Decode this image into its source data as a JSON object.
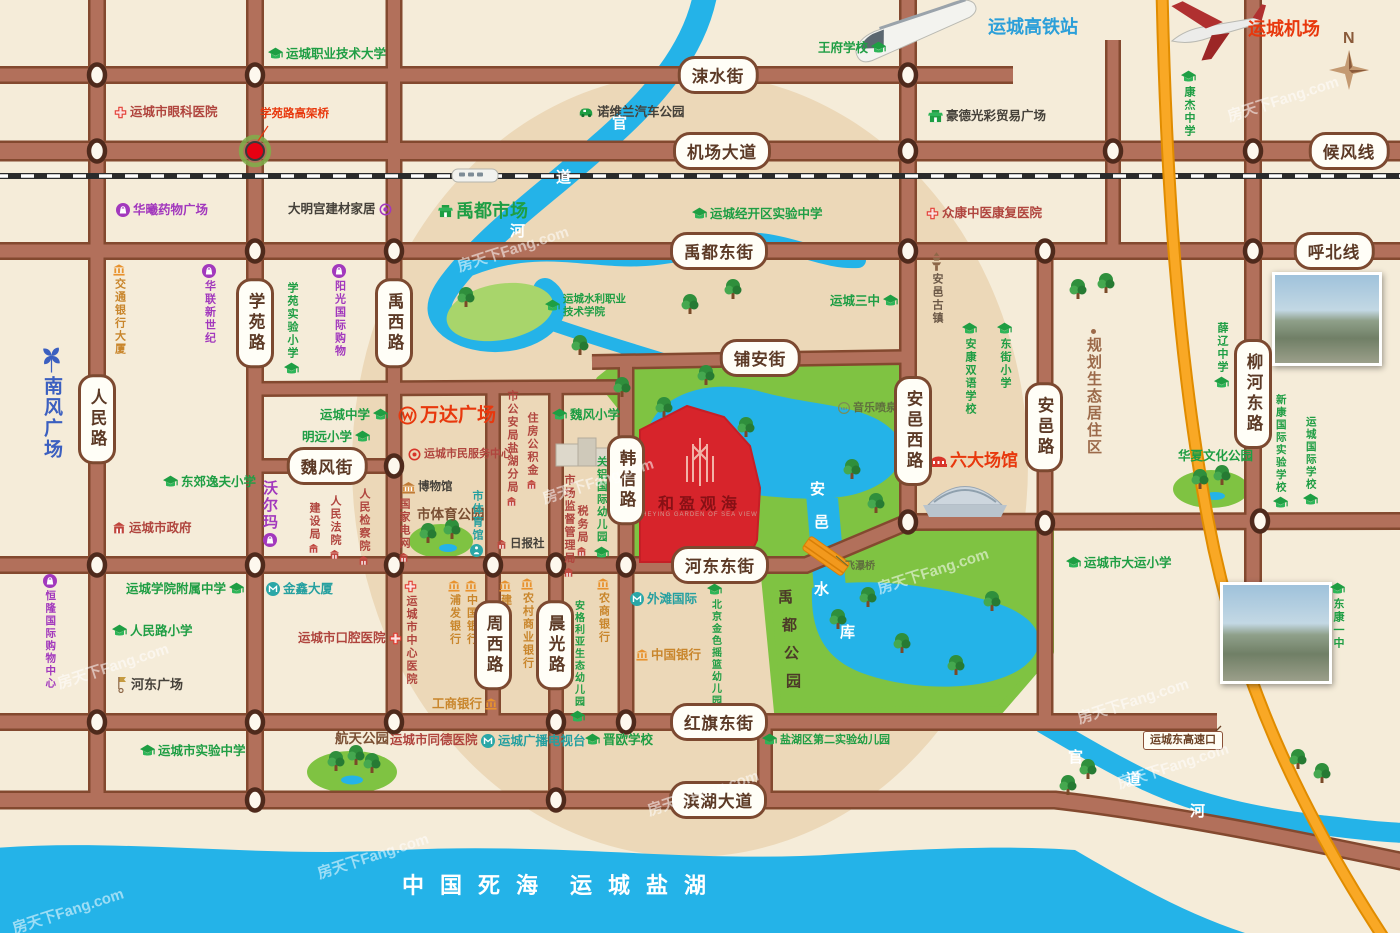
{
  "watermark": "房天下Fang.com",
  "compass_label": "N",
  "project": {
    "name": "和盈观海",
    "subtitle": "HEYING GARDEN OF SEA VIEW"
  },
  "sea": {
    "labels": [
      "中国死海",
      "运城盐湖"
    ]
  },
  "river_name": "官道河",
  "reservoir_name": "安邑水库",
  "park_name": "禹都公园",
  "road_labels": [
    {
      "text": "涑水街",
      "x": 718,
      "y": 75
    },
    {
      "text": "机场大道",
      "x": 722,
      "y": 151
    },
    {
      "text": "候风线",
      "x": 1349,
      "y": 151
    },
    {
      "text": "禹都东街",
      "x": 719,
      "y": 251
    },
    {
      "text": "呼北线",
      "x": 1334,
      "y": 251
    },
    {
      "text": "铺安街",
      "x": 760,
      "y": 358
    },
    {
      "text": "魏风街",
      "x": 327,
      "y": 466
    },
    {
      "text": "河东东街",
      "x": 720,
      "y": 565
    },
    {
      "text": "红旗东街",
      "x": 719,
      "y": 722
    },
    {
      "text": "滨湖大道",
      "x": 718,
      "y": 800
    },
    {
      "text": "人民路",
      "x": 97,
      "y": 419,
      "vertical": true
    },
    {
      "text": "学苑路",
      "x": 255,
      "y": 323,
      "vertical": true
    },
    {
      "text": "禹西路",
      "x": 394,
      "y": 323,
      "vertical": true
    },
    {
      "text": "周西路",
      "x": 493,
      "y": 645,
      "vertical": true
    },
    {
      "text": "晨光路",
      "x": 555,
      "y": 645,
      "vertical": true
    },
    {
      "text": "韩信路",
      "x": 626,
      "y": 480,
      "vertical": true
    },
    {
      "text": "安邑西路",
      "x": 913,
      "y": 431,
      "vertical": true
    },
    {
      "text": "安邑路",
      "x": 1044,
      "y": 427,
      "vertical": true
    },
    {
      "text": "柳河东路",
      "x": 1253,
      "y": 394,
      "vertical": true
    }
  ],
  "places": [
    {
      "l": "运城高铁站",
      "t": "blue",
      "x": 988,
      "y": 18,
      "fs": 18
    },
    {
      "l": "王府学校",
      "t": "school",
      "x": 818,
      "y": 41,
      "ip": "r"
    },
    {
      "l": "运城机场",
      "t": "redbig",
      "x": 1248,
      "y": 20,
      "fs": 18
    },
    {
      "l": "康杰中学",
      "t": "school",
      "x": 1181,
      "y": 70,
      "v": 1,
      "ip": "t"
    },
    {
      "l": "运城职业技术大学",
      "t": "school",
      "x": 268,
      "y": 47,
      "ip": "l"
    },
    {
      "l": "运城市眼科医院",
      "t": "hospital",
      "x": 114,
      "y": 106,
      "ip": "l"
    },
    {
      "l": "学苑路高架桥",
      "t": "redsmall",
      "x": 260,
      "y": 109,
      "fs": 11.5
    },
    {
      "l": "诺维兰汽车公园",
      "t": "dark",
      "x": 578,
      "y": 106,
      "ip": "l",
      "icon": "car"
    },
    {
      "l": "豪德光彩贸易广场",
      "t": "dark",
      "x": 928,
      "y": 110,
      "ip": "l",
      "icon": "market"
    },
    {
      "l": "华曦药物广场",
      "t": "shop",
      "x": 116,
      "y": 203,
      "ip": "l"
    },
    {
      "l": "大明宫建材家居",
      "t": "dark",
      "x": 288,
      "y": 203,
      "ip": "r",
      "icon": "pcircle"
    },
    {
      "l": "禹都市场",
      "t": "market",
      "x": 438,
      "y": 202,
      "ip": "l",
      "fs": 18
    },
    {
      "l": "运城经开区实验中学",
      "t": "school",
      "x": 692,
      "y": 207,
      "ip": "l"
    },
    {
      "l": "众康中医康复医院",
      "t": "hospital",
      "x": 926,
      "y": 207,
      "ip": "l"
    },
    {
      "l": "运城三中",
      "t": "school",
      "x": 830,
      "y": 294,
      "ip": "r"
    },
    {
      "l": "安邑古镇",
      "t": "pagoda",
      "x": 930,
      "y": 252,
      "v": 1,
      "ip": "t"
    },
    {
      "l": "安康双语学校",
      "t": "school",
      "x": 962,
      "y": 322,
      "v": 1,
      "ip": "t"
    },
    {
      "l": "东街小学",
      "t": "school",
      "x": 997,
      "y": 322,
      "v": 1,
      "ip": "t"
    },
    {
      "l": "运城水利职业技术学院",
      "t": "school2",
      "x": 545,
      "y": 293,
      "ip": "l"
    },
    {
      "l": "薛辽中学",
      "t": "school",
      "x": 1214,
      "y": 322,
      "v": 1,
      "ip": "b"
    },
    {
      "l": "规划生态居住区",
      "t": "brown",
      "x": 1086,
      "y": 328,
      "v": 1,
      "ip": "t",
      "icon": "dot",
      "fs": 15
    },
    {
      "l": "新康国际实验学校",
      "t": "school",
      "x": 1273,
      "y": 394,
      "v": 1,
      "ip": "b",
      "fs": 10.5
    },
    {
      "l": "运城国际学校",
      "t": "school",
      "x": 1303,
      "y": 416,
      "v": 1,
      "ip": "b",
      "fs": 10.5
    },
    {
      "l": "交通银行大厦",
      "t": "bank",
      "x": 113,
      "y": 264,
      "v": 1,
      "ip": "t"
    },
    {
      "l": "华联新世纪",
      "t": "shop",
      "x": 202,
      "y": 264,
      "v": 1,
      "ip": "t"
    },
    {
      "l": "学苑实验小学",
      "t": "school",
      "x": 284,
      "y": 282,
      "v": 1,
      "ip": "b"
    },
    {
      "l": "阳光国际购物",
      "t": "shop",
      "x": 332,
      "y": 264,
      "v": 1,
      "ip": "t"
    },
    {
      "l": "南风广场",
      "t": "bluev",
      "x": 38,
      "y": 342,
      "v": 1,
      "ip": "t",
      "icon": "pinwheel",
      "fs": 19
    },
    {
      "l": "东郊逸夫小学",
      "t": "school",
      "x": 163,
      "y": 475,
      "ip": "l"
    },
    {
      "l": "运城中学",
      "t": "school",
      "x": 320,
      "y": 408,
      "ip": "r"
    },
    {
      "l": "明远小学",
      "t": "school",
      "x": 302,
      "y": 430,
      "ip": "r"
    },
    {
      "l": "沃尔玛",
      "t": "shop",
      "x": 262,
      "y": 480,
      "v": 1,
      "ip": "b",
      "fs": 15
    },
    {
      "l": "运城市政府",
      "t": "gov",
      "x": 112,
      "y": 521,
      "ip": "l"
    },
    {
      "l": "建设局",
      "t": "govs",
      "x": 308,
      "y": 502,
      "v": 1,
      "ip": "b"
    },
    {
      "l": "人民法院",
      "t": "govs",
      "x": 329,
      "y": 495,
      "v": 1,
      "ip": "b"
    },
    {
      "l": "人民检察院",
      "t": "govs",
      "x": 358,
      "y": 488,
      "v": 1,
      "ip": "b"
    },
    {
      "l": "万达广场",
      "t": "redbig",
      "x": 398,
      "y": 406,
      "ip": "l",
      "icon": "wanda",
      "fs": 19
    },
    {
      "l": "运城市民服务中心",
      "t": "redsm",
      "x": 408,
      "y": 448,
      "ip": "l",
      "icon": "target",
      "fs": 11
    },
    {
      "l": "博物馆",
      "t": "dark",
      "x": 402,
      "y": 482,
      "ip": "l",
      "icon": "museum",
      "fs": 11.5
    },
    {
      "l": "国家电网",
      "t": "govs",
      "x": 398,
      "y": 498,
      "v": 1,
      "ip": "b"
    },
    {
      "l": "市体育公园",
      "t": "brownbold",
      "x": 417,
      "y": 508,
      "fs": 13.5
    },
    {
      "l": "市体育馆",
      "t": "stadium",
      "x": 470,
      "y": 490,
      "v": 1,
      "ip": "b"
    },
    {
      "l": "日报社",
      "t": "dark",
      "x": 496,
      "y": 539,
      "ip": "l",
      "icon": "govsm",
      "fs": 11.5
    },
    {
      "l": "市公安局盐湖分局",
      "t": "govs",
      "x": 506,
      "y": 390,
      "v": 1,
      "ip": "b"
    },
    {
      "l": "住房公积金",
      "t": "govs",
      "x": 526,
      "y": 412,
      "v": 1,
      "ip": "b"
    },
    {
      "l": "魏风小学",
      "t": "school",
      "x": 552,
      "y": 408,
      "ip": "l"
    },
    {
      "l": "关铝国际幼儿园",
      "t": "school",
      "x": 594,
      "y": 456,
      "v": 1,
      "ip": "b",
      "fs": 10.5
    },
    {
      "l": "市场监督管理局",
      "t": "govs",
      "x": 563,
      "y": 474,
      "v": 1,
      "ip": "b"
    },
    {
      "l": "税务局",
      "t": "govs",
      "x": 576,
      "y": 505,
      "v": 1,
      "ip": "b"
    },
    {
      "l": "音乐喷泉",
      "t": "fountain",
      "x": 838,
      "y": 402,
      "ip": "l",
      "fs": 11
    },
    {
      "l": "六大场馆",
      "t": "redbig",
      "x": 930,
      "y": 452,
      "ip": "l",
      "icon": "venues",
      "fs": 17
    },
    {
      "l": "恒隆国际购物中心",
      "t": "shop",
      "x": 43,
      "y": 574,
      "v": 1,
      "ip": "t",
      "fs": 10.5
    },
    {
      "l": "运城学院附属中学",
      "t": "school",
      "x": 126,
      "y": 582,
      "ip": "r"
    },
    {
      "l": "金鑫大厦",
      "t": "office",
      "x": 266,
      "y": 582,
      "ip": "l"
    },
    {
      "l": "人民路小学",
      "t": "school",
      "x": 112,
      "y": 624,
      "ip": "l"
    },
    {
      "l": "运城市口腔医院",
      "t": "hospital",
      "x": 298,
      "y": 632,
      "ip": "r"
    },
    {
      "l": "河东广场",
      "t": "dark",
      "x": 116,
      "y": 676,
      "ip": "l",
      "icon": "flag",
      "fs": 13
    },
    {
      "l": "运城市中心医院",
      "t": "hospital",
      "x": 404,
      "y": 580,
      "v": 1,
      "ip": "t"
    },
    {
      "l": "浦发银行",
      "t": "bank",
      "x": 448,
      "y": 580,
      "v": 1,
      "ip": "t"
    },
    {
      "l": "中国银行",
      "t": "bank",
      "x": 465,
      "y": 580,
      "v": 1,
      "ip": "t"
    },
    {
      "l": "建设银行",
      "t": "bank",
      "x": 499,
      "y": 580,
      "v": 1,
      "ip": "t"
    },
    {
      "l": "农村商业银行",
      "t": "bank",
      "x": 521,
      "y": 578,
      "v": 1,
      "ip": "t"
    },
    {
      "l": "农商银行",
      "t": "bank",
      "x": 597,
      "y": 578,
      "v": 1,
      "ip": "t"
    },
    {
      "l": "安格利亚生态幼儿园",
      "t": "school",
      "x": 570,
      "y": 600,
      "v": 1,
      "ip": "b",
      "fs": 10
    },
    {
      "l": "外滩国际",
      "t": "office",
      "x": 630,
      "y": 592,
      "ip": "l"
    },
    {
      "l": "北京金色摇篮幼儿园",
      "t": "school",
      "x": 707,
      "y": 583,
      "v": 1,
      "ip": "t",
      "fs": 10
    },
    {
      "l": "中国银行",
      "t": "bank",
      "x": 636,
      "y": 649,
      "ip": "l",
      "fs": 12.5
    },
    {
      "l": "工商银行",
      "t": "bank",
      "x": 432,
      "y": 698,
      "ip": "r",
      "fs": 12.5
    },
    {
      "l": "运城市同德医院",
      "t": "hospital",
      "x": 390,
      "y": 734,
      "ip": "r"
    },
    {
      "l": "运城广播电视台",
      "t": "office",
      "x": 481,
      "y": 734,
      "ip": "l"
    },
    {
      "l": "晋欧学校",
      "t": "school",
      "x": 585,
      "y": 733,
      "ip": "l"
    },
    {
      "l": "盐湖区第二实验幼儿园",
      "t": "school",
      "x": 762,
      "y": 733,
      "ip": "l",
      "fs": 11
    },
    {
      "l": "运城市实验中学",
      "t": "school",
      "x": 140,
      "y": 744,
      "ip": "l"
    },
    {
      "l": "航天公园",
      "t": "brownbold",
      "x": 335,
      "y": 732,
      "fs": 13.5
    },
    {
      "l": "华夏文化公园",
      "t": "parkname",
      "x": 1178,
      "y": 450,
      "fs": 12.5
    },
    {
      "l": "运城市大运小学",
      "t": "school",
      "x": 1066,
      "y": 556,
      "ip": "l"
    },
    {
      "l": "东康一中",
      "t": "school",
      "x": 1330,
      "y": 582,
      "v": 1,
      "ip": "t"
    },
    {
      "l": "飞瀑桥",
      "t": "smalldark",
      "x": 845,
      "y": 562,
      "fs": 10
    },
    {
      "l": "运城东高速口",
      "t": "boxed",
      "x": 1143,
      "y": 731,
      "fs": 11
    }
  ]
}
